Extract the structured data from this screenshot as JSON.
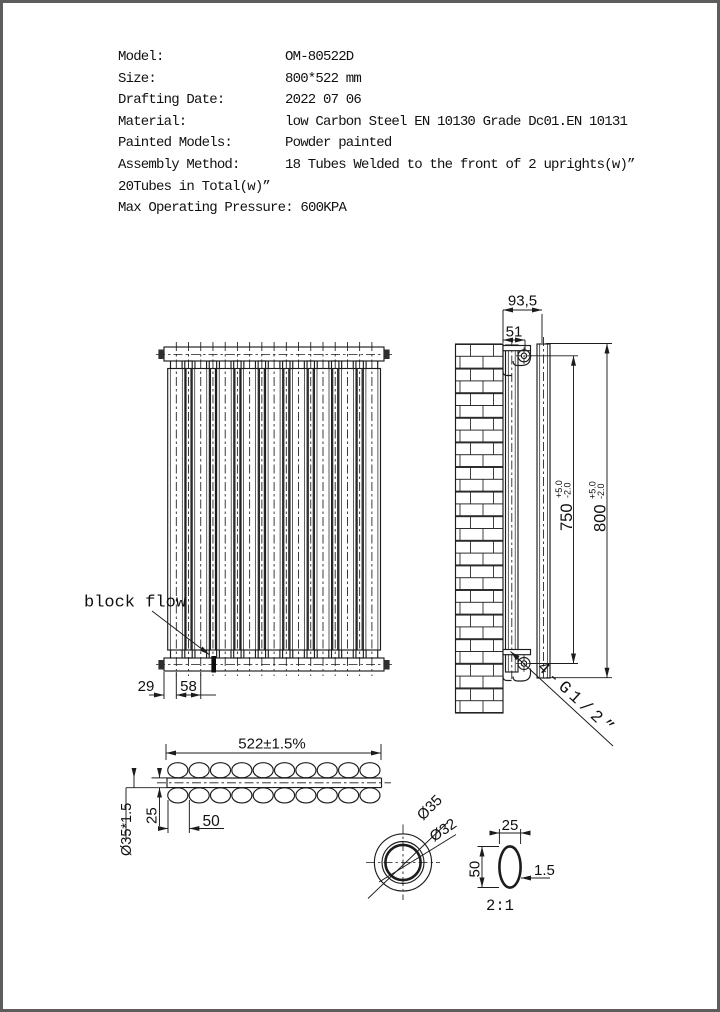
{
  "header": {
    "rows": [
      {
        "label": "Model:",
        "value": "OM-80522D"
      },
      {
        "label": "Size:",
        "value": "800*522 mm"
      },
      {
        "label": "Drafting Date:",
        "value": "2022 07 06"
      },
      {
        "label": "Material:",
        "value": "low Carbon Steel  EN 10130 Grade Dc01.EN 10131"
      },
      {
        "label": "Painted Models:",
        "value": "Powder painted"
      },
      {
        "label": "Assembly Method:",
        "value": "18 Tubes Welded to the front of 2 uprights(w)”"
      },
      {
        "label": "20Tubes in Total(w)”",
        "value": ""
      },
      {
        "label": "Max Operating Pressure: 600KPA",
        "value": ""
      }
    ]
  },
  "front_view": {
    "label_block_flow": "block flow",
    "dim_edge_offset": "29",
    "dim_tube_pitch": "58"
  },
  "side_view": {
    "dim_depth": "93,5",
    "dim_wall_to_center": "51",
    "dim_bracket_span": "750",
    "dim_bracket_span_tol_plus": "+5.0",
    "dim_bracket_span_tol_minus": "-2.0",
    "dim_height": "800",
    "dim_height_tol_plus": "+5.0",
    "dim_height_tol_minus": "-2.0",
    "label_connections": "4-G1/2”"
  },
  "bottom_view": {
    "dim_width": "522±1.5%",
    "dim_tube_spec": "Ø35*1.5",
    "dim_row_offset": "25",
    "dim_tube_pitch": "50"
  },
  "detail_circle": {
    "dim_outer_dia": "Ø35",
    "dim_inner_dia": "Ø32"
  },
  "detail_oval": {
    "dim_width": "25",
    "dim_depth": "50",
    "dim_wall": "1.5"
  },
  "detail_scale_label": "2:1"
}
